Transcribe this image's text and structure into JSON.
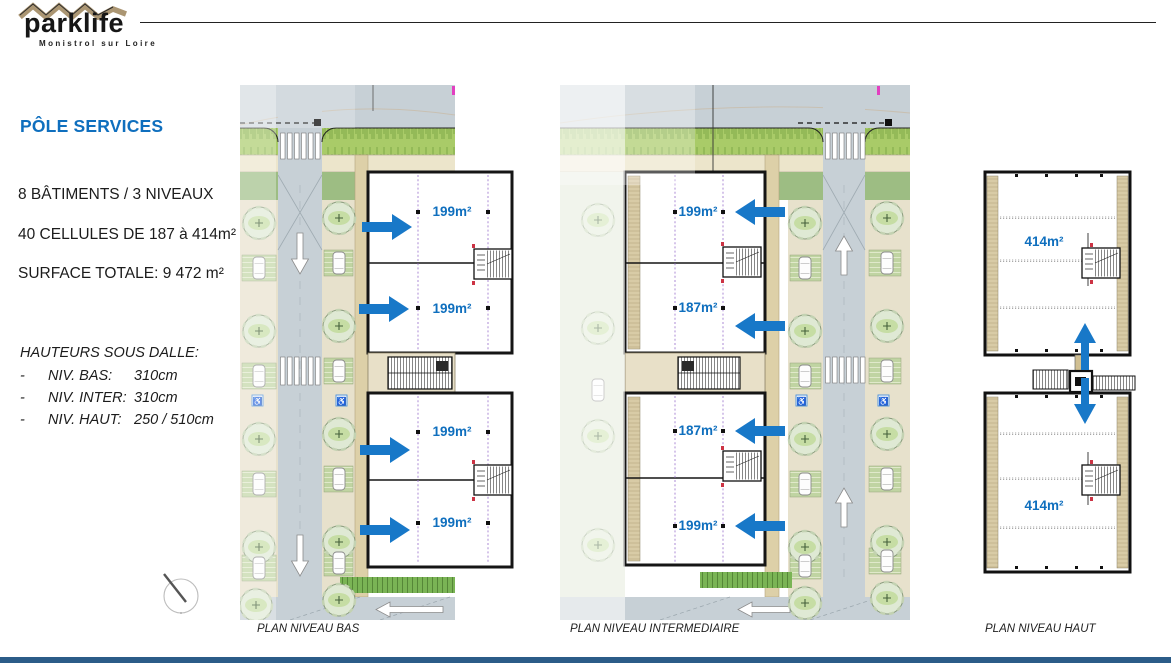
{
  "logo": {
    "name": "parklife",
    "subtitle": "Monistrol sur Loire"
  },
  "info_panel": {
    "title": "PÔLE SERVICES",
    "line1": "8 BÂTIMENTS / 3 NIVEAUX",
    "line2": "40 CELLULES DE 187 à 414m²",
    "line3": "SURFACE TOTALE: 9 472 m²",
    "heights_title": "HAUTEURS SOUS DALLE:",
    "bullet": "-",
    "heights": [
      {
        "label": "NIV. BAS:",
        "value": "310cm"
      },
      {
        "label": "NIV. INTER:",
        "value": "310cm"
      },
      {
        "label": "NIV. HAUT:",
        "value": "250 / 510cm"
      }
    ]
  },
  "plans": {
    "bas": {
      "caption": "PLAN NIVEAU BAS",
      "cells": [
        "199m²",
        "199m²",
        "199m²",
        "199m²"
      ]
    },
    "inter": {
      "caption": "PLAN NIVEAU INTERMEDIAIRE",
      "cells": [
        "199m²",
        "187m²",
        "187m²",
        "199m²"
      ]
    },
    "haut": {
      "caption": "PLAN NIVEAU HAUT",
      "cells": [
        "414m²",
        "414m²"
      ]
    }
  },
  "colors": {
    "accent_blue": "#0f6fbe",
    "arrow_blue": "#1878c8",
    "footer_bar": "#2b5c88"
  }
}
